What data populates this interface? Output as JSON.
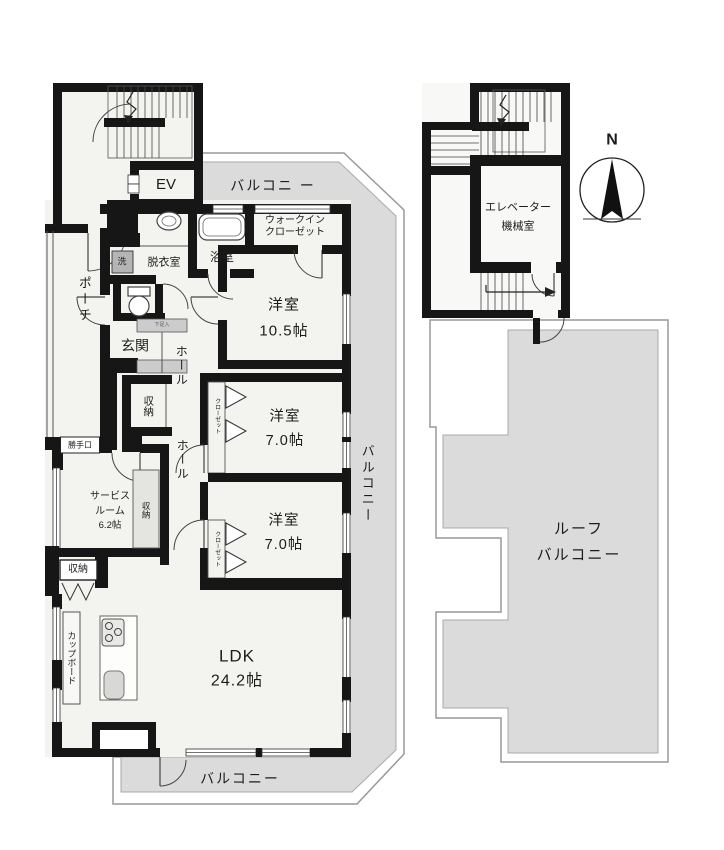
{
  "unit": {
    "rooms": {
      "ldk": {
        "name": "LDK",
        "size": "24.2帖"
      },
      "bedroom_large": {
        "name": "洋室",
        "size": "10.5帖"
      },
      "bedroom_mid": {
        "name": "洋室",
        "size": "7.0帖"
      },
      "bedroom_small": {
        "name": "洋室",
        "size": "7.0帖"
      },
      "service_room": {
        "line1": "サービス",
        "line2": "ルーム",
        "size": "6.2帖"
      },
      "entrance": "玄関",
      "hall_upper": "ホール",
      "hall_lower": "ホール",
      "bathroom": "浴室",
      "dressing_room": "脱衣室",
      "laundry": "洗",
      "shoe_cabinet": "下足入",
      "walk_in_closet": {
        "line1": "ウォークイン",
        "line2": "クローゼット"
      },
      "closet_upper": "クローゼット",
      "closet_lower": "クローゼット",
      "storage_hall": "収納",
      "storage_service": "収納",
      "storage_kitchen": "収納",
      "cupboard": "カップボード",
      "porch": "ポーチ",
      "back_door": "勝手口",
      "elevator": "EV"
    },
    "balconies": {
      "top": "バルコニ ー",
      "right": "バルコニー",
      "bottom": "バルコニー"
    }
  },
  "annex": {
    "machine_room": {
      "line1": "エレベーター",
      "line2": "機械室"
    },
    "roof_balcony": {
      "line1": "ルーフ",
      "line2": "バルコニー"
    }
  },
  "compass": {
    "north": "N"
  },
  "colors": {
    "wall": "#161616",
    "balcony_fill": "#dbdbdb",
    "room_fill": "#f3f3f0",
    "outline": "#999999"
  }
}
